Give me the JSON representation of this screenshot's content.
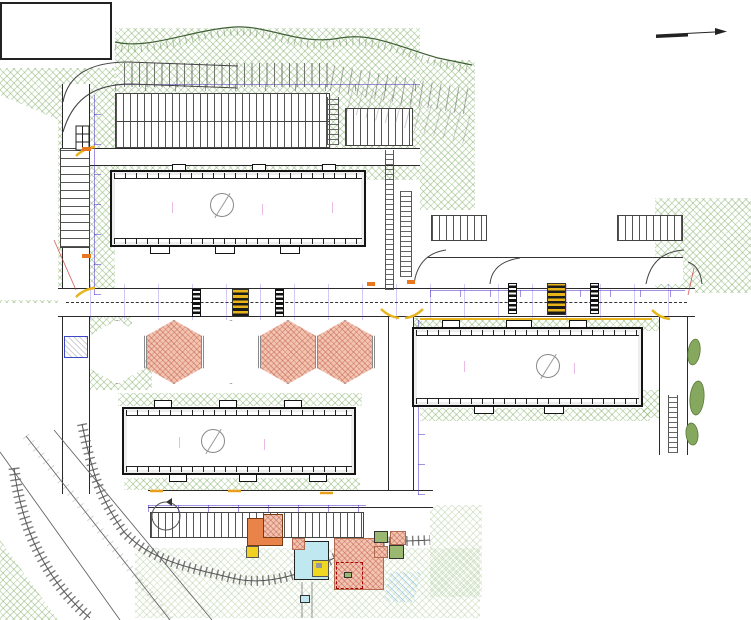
{
  "colors": {
    "sign_blue": "#1041a8",
    "sign_red": "#cc1f1f",
    "grid_red": "#b32020",
    "dim_purple": "#5b3fd6",
    "hatch_green": "#6ea55a",
    "zebra_yellow": "#e8b41c",
    "building_outline": "#141414"
  },
  "glyphs": {
    "parking": "P",
    "speed_limit": "40",
    "no_stop_cross": "✕",
    "uturn_arrow": "↶",
    "chevron": "<"
  },
  "buildings": [
    {
      "number": "7",
      "floors_label": "16 эт"
    },
    {
      "number": "8",
      "floors_label": "16 эт"
    },
    {
      "number": "4",
      "floors_label": "16 эт"
    }
  ],
  "labels": [
    {
      "t": "тротуар",
      "x": 248,
      "y": 166
    },
    {
      "t": "тротуар",
      "x": 146,
      "y": 372
    },
    {
      "t": "тротуар",
      "x": 334,
      "y": 372
    },
    {
      "t": "тротуар",
      "x": 134,
      "y": 395
    },
    {
      "t": "тротуар",
      "x": 430,
      "y": 312
    },
    {
      "t": "тротуар",
      "x": 584,
      "y": 312
    },
    {
      "t": "тротуар",
      "x": 447,
      "y": 281
    },
    {
      "t": "тротуар",
      "x": 603,
      "y": 281
    },
    {
      "t": "тротуар",
      "x": 303,
      "y": 487
    },
    {
      "t": "дворовый проезд",
      "x": 222,
      "y": 499,
      "cls": "big"
    },
    {
      "t": "улица местного значения",
      "x": 384,
      "y": 302,
      "cls": "big"
    },
    {
      "t": "местоположение ДОУ (на перспективу)",
      "x": 497,
      "y": 206
    },
    {
      "t": "боковой проезд",
      "x": 83,
      "y": 88,
      "cls": "v"
    },
    {
      "t": "боковой проезд",
      "x": 83,
      "y": 168,
      "cls": "v"
    },
    {
      "t": "боковой проезд",
      "x": 392,
      "y": 330,
      "cls": "v"
    },
    {
      "t": "боковой проезд",
      "x": 662,
      "y": 352,
      "cls": "v"
    },
    {
      "t": "отмостка",
      "x": 108,
      "y": 425,
      "cls": "v"
    },
    {
      "t": "отмостка",
      "x": 349,
      "y": 412,
      "cls": "v"
    },
    {
      "t": "отмостка",
      "x": 643,
      "y": 356,
      "cls": "v"
    },
    {
      "t": "съезд в подзем. стоянку",
      "x": 42,
      "y": 146,
      "cls": "v red"
    },
    {
      "t": "въезд в подзем. стоянку",
      "x": 50,
      "y": 146,
      "cls": "v red"
    },
    {
      "t": "съезд в подзем. стоянку",
      "x": 691,
      "y": 208,
      "cls": "v red"
    },
    {
      "t": "школа микрорайонная",
      "x": 93,
      "y": 8,
      "cls": "v tiny"
    },
    {
      "t": "ТП",
      "x": 70,
      "y": 341,
      "cls": "tp"
    },
    {
      "t": "С",
      "x": 727,
      "y": 27,
      "cls": "north"
    }
  ],
  "dims": [
    {
      "t": "6,00",
      "x": 136,
      "y": 112,
      "cls": "blu v"
    },
    {
      "t": "6,00",
      "x": 26,
      "y": 100,
      "cls": "blu",
      "rot": -50
    },
    {
      "t": "R=6,00",
      "x": 56,
      "y": 93,
      "cls": "blu"
    },
    {
      "t": "2,50",
      "x": 188,
      "y": 96,
      "cls": "blu v"
    },
    {
      "t": "5,50",
      "x": 370,
      "y": 246,
      "cls": "blu v"
    },
    {
      "t": "3,50",
      "x": 420,
      "y": 346,
      "cls": "blu v"
    },
    {
      "t": "12,00",
      "x": 162,
      "y": 330,
      "cls": "v"
    },
    {
      "t": "30,00",
      "x": 212,
      "y": 336,
      "cls": "v"
    },
    {
      "t": "18,00",
      "x": 252,
      "y": 330,
      "cls": "v"
    },
    {
      "t": "24,00",
      "x": 302,
      "y": 336,
      "cls": "v"
    },
    {
      "t": "9,00",
      "x": 472,
      "y": 300,
      "cls": "v"
    },
    {
      "t": "15,00",
      "x": 522,
      "y": 336,
      "cls": "v"
    },
    {
      "t": "21,00",
      "x": 582,
      "y": 300,
      "cls": "v"
    },
    {
      "t": "27,00",
      "x": 638,
      "y": 336,
      "cls": "v"
    }
  ],
  "signs": [
    {
      "type": "p",
      "x": 190,
      "y": 54
    },
    {
      "type": "plate",
      "x": 192,
      "y": 70
    },
    {
      "type": "p",
      "x": 231,
      "y": 54
    },
    {
      "type": "plate",
      "x": 233,
      "y": 70
    },
    {
      "type": "p",
      "x": 197,
      "y": 147,
      "rot": 180
    },
    {
      "type": "p",
      "x": 234,
      "y": 147,
      "rot": 180
    },
    {
      "type": "ped",
      "x": 109,
      "y": 247,
      "rot": -90
    },
    {
      "type": "uturn",
      "x": 126,
      "y": 268
    },
    {
      "type": "ped",
      "x": 180,
      "y": 257
    },
    {
      "type": "p",
      "x": 196,
      "y": 252
    },
    {
      "type": "plate",
      "x": 208,
      "y": 254
    },
    {
      "type": "cam",
      "x": 251,
      "y": 251
    },
    {
      "type": "ring",
      "x": 292,
      "y": 266
    },
    {
      "type": "plate",
      "x": 305,
      "y": 267
    },
    {
      "type": "p",
      "x": 318,
      "y": 261
    },
    {
      "type": "plate",
      "x": 330,
      "y": 262
    },
    {
      "type": "ped",
      "x": 383,
      "y": 244
    },
    {
      "type": "noentry",
      "x": 44,
      "y": 294
    },
    {
      "type": "chev",
      "x": 56,
      "y": 276
    },
    {
      "type": "bar",
      "x": 69,
      "y": 280
    },
    {
      "type": "stairs",
      "x": 61,
      "y": 319
    },
    {
      "type": "car",
      "x": 132,
      "y": 328
    },
    {
      "type": "nostop",
      "x": 149,
      "y": 329
    },
    {
      "type": "plate",
      "x": 163,
      "y": 329
    },
    {
      "type": "ring",
      "x": 175,
      "y": 328
    },
    {
      "type": "ped",
      "x": 190,
      "y": 325
    },
    {
      "type": "ped",
      "x": 221,
      "y": 327
    },
    {
      "type": "ped",
      "x": 262,
      "y": 323
    },
    {
      "type": "nostop",
      "x": 319,
      "y": 330
    },
    {
      "type": "plate",
      "x": 332,
      "y": 331
    },
    {
      "type": "nostop",
      "x": 368,
      "y": 336
    },
    {
      "type": "ped",
      "x": 388,
      "y": 339,
      "rot": -90
    },
    {
      "type": "ring",
      "x": 440,
      "y": 263
    },
    {
      "type": "plate",
      "x": 453,
      "y": 264
    },
    {
      "type": "ped",
      "x": 515,
      "y": 267,
      "rot": -90
    },
    {
      "type": "car",
      "x": 548,
      "y": 263
    },
    {
      "type": "p",
      "x": 562,
      "y": 260
    },
    {
      "type": "ped",
      "x": 593,
      "y": 257,
      "rot": -90
    },
    {
      "type": "ring",
      "x": 606,
      "y": 256
    },
    {
      "type": "plate",
      "x": 619,
      "y": 254
    },
    {
      "type": "yield",
      "x": 631,
      "y": 261
    },
    {
      "type": "p",
      "x": 668,
      "y": 252
    },
    {
      "type": "plate",
      "x": 681,
      "y": 254
    },
    {
      "type": "nostop",
      "x": 430,
      "y": 336
    },
    {
      "type": "ring",
      "x": 445,
      "y": 339
    },
    {
      "type": "ring",
      "x": 486,
      "y": 339
    },
    {
      "type": "ped",
      "x": 500,
      "y": 338
    },
    {
      "type": "cam",
      "x": 526,
      "y": 328
    },
    {
      "type": "ped",
      "x": 591,
      "y": 334,
      "rot": -90
    },
    {
      "type": "nostop",
      "x": 606,
      "y": 335
    },
    {
      "type": "p",
      "x": 622,
      "y": 353
    },
    {
      "type": "plate",
      "x": 634,
      "y": 351
    },
    {
      "type": "noentry",
      "x": 685,
      "y": 324
    },
    {
      "type": "chev",
      "x": 677,
      "y": 320
    },
    {
      "type": "uturn",
      "x": 663,
      "y": 361
    },
    {
      "type": "p",
      "x": 152,
      "y": 542,
      "rot": 180
    },
    {
      "type": "p",
      "x": 274,
      "y": 542,
      "rot": 180
    },
    {
      "type": "p",
      "x": 379,
      "y": 513,
      "rot": 180
    },
    {
      "type": "plate",
      "x": 380,
      "y": 506
    }
  ],
  "gridlines": [
    {
      "x": 140,
      "y": 266,
      "len": 86
    },
    {
      "x": 225,
      "y": 247,
      "len": 173
    },
    {
      "x": 267,
      "y": 286,
      "len": 146
    },
    {
      "x": 330,
      "y": 283,
      "len": 119
    },
    {
      "x": 361,
      "y": 240,
      "len": 265
    },
    {
      "x": 430,
      "y": 228,
      "len": 187
    },
    {
      "x": 476,
      "y": 232,
      "len": 188
    },
    {
      "x": 547,
      "y": 228,
      "len": 190
    },
    {
      "x": 605,
      "y": 230,
      "len": 190
    },
    {
      "x": 646,
      "y": 232,
      "len": 68
    },
    {
      "x": 663,
      "y": 282,
      "len": 138
    },
    {
      "x": 697,
      "y": 230,
      "len": 100
    },
    {
      "x": 650,
      "y": 283,
      "len": 98,
      "h": true
    }
  ]
}
